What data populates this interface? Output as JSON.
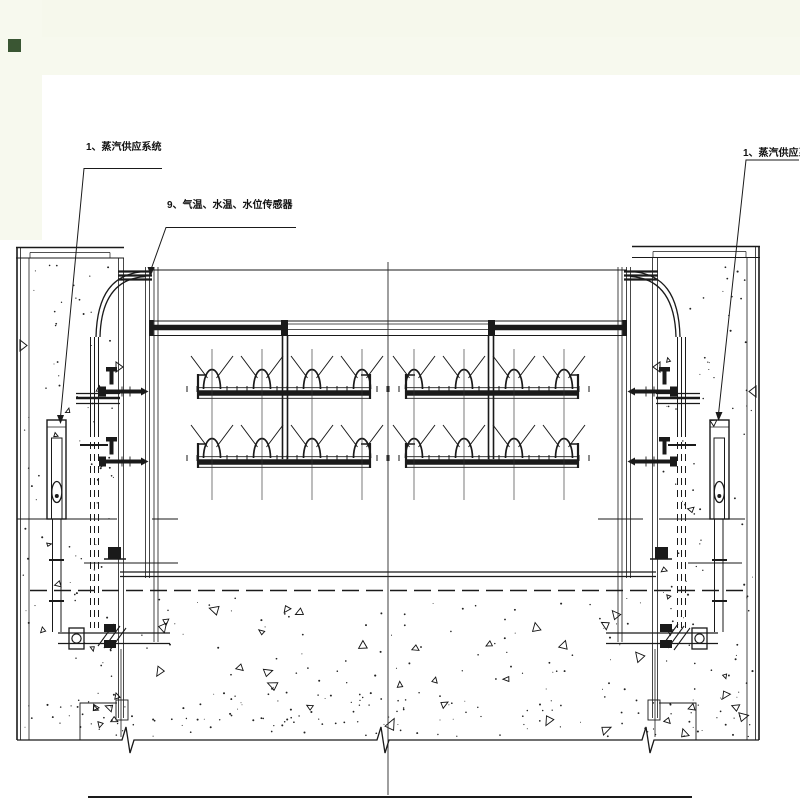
{
  "page": {
    "background_color": "#f8faf1",
    "paper_color": "#ffffff",
    "ink_color": "#1a1a1a",
    "corner_mark_color": "#3a5633"
  },
  "labels": {
    "steam_left": "1、蒸汽供应系统",
    "sensors": "9、气温、水温、水位传感器",
    "steam_right": "1、蒸汽供应系统"
  }
}
